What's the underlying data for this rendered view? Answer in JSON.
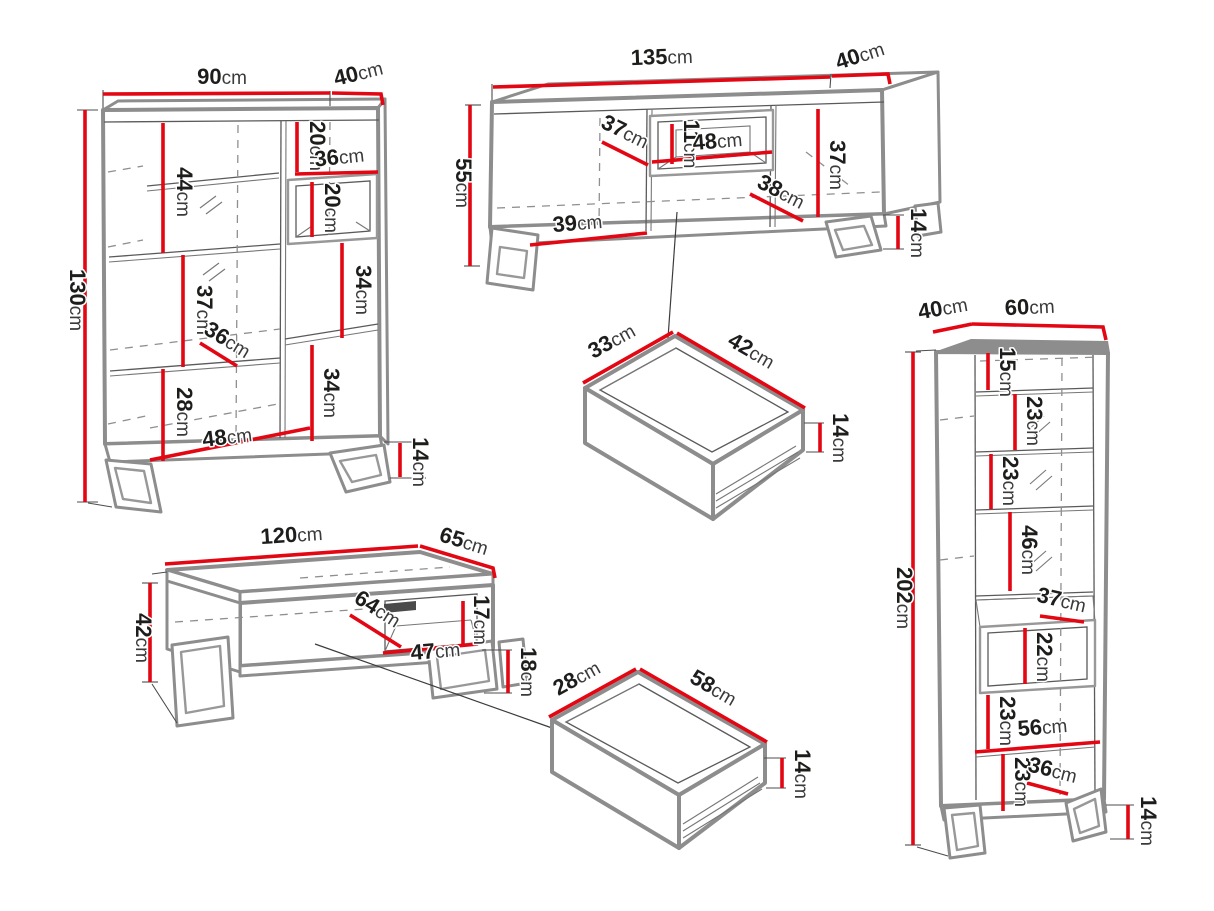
{
  "unit": "cm",
  "colors": {
    "dimension": "#e30613",
    "outline": "#8d8d8d",
    "detail": "#5a5a5a",
    "text": "#1d1d1b",
    "background": "#ffffff"
  },
  "highboard": {
    "width": "90",
    "depth": "40",
    "height": "130",
    "top_section": "20",
    "niche_width": "36",
    "niche_height": "20",
    "upper_shelf": "44",
    "middle_shelf": "37",
    "inner_diagonal": "36",
    "lower_section": "28",
    "right_upper": "34",
    "right_lower": "34",
    "bottom_width": "48",
    "leg_height": "14"
  },
  "tv_stand": {
    "width": "135",
    "depth": "40",
    "height": "55",
    "left_door": "37",
    "niche_height": "11",
    "niche_width": "48",
    "right_inner_height": "37",
    "right_door": "38",
    "left_bottom": "39",
    "leg_height": "14"
  },
  "tv_drawer": {
    "depth": "33",
    "width": "42",
    "height": "14"
  },
  "tall_cabinet": {
    "depth": "40",
    "width": "60",
    "height": "202",
    "top_section": "15",
    "section_2": "23",
    "section_3": "23",
    "section_4": "46",
    "niche_depth": "37",
    "niche_height": "22",
    "section_5": "23",
    "inner_width": "56",
    "section_6": "23",
    "bottom_diagonal": "36",
    "leg_height": "14"
  },
  "coffee_table": {
    "width": "120",
    "depth": "65",
    "height": "42",
    "niche_height": "17",
    "inner_diagonal": "64",
    "niche_width": "47",
    "leg_height": "18"
  },
  "table_drawer": {
    "depth": "28",
    "width": "58",
    "height": "14"
  }
}
